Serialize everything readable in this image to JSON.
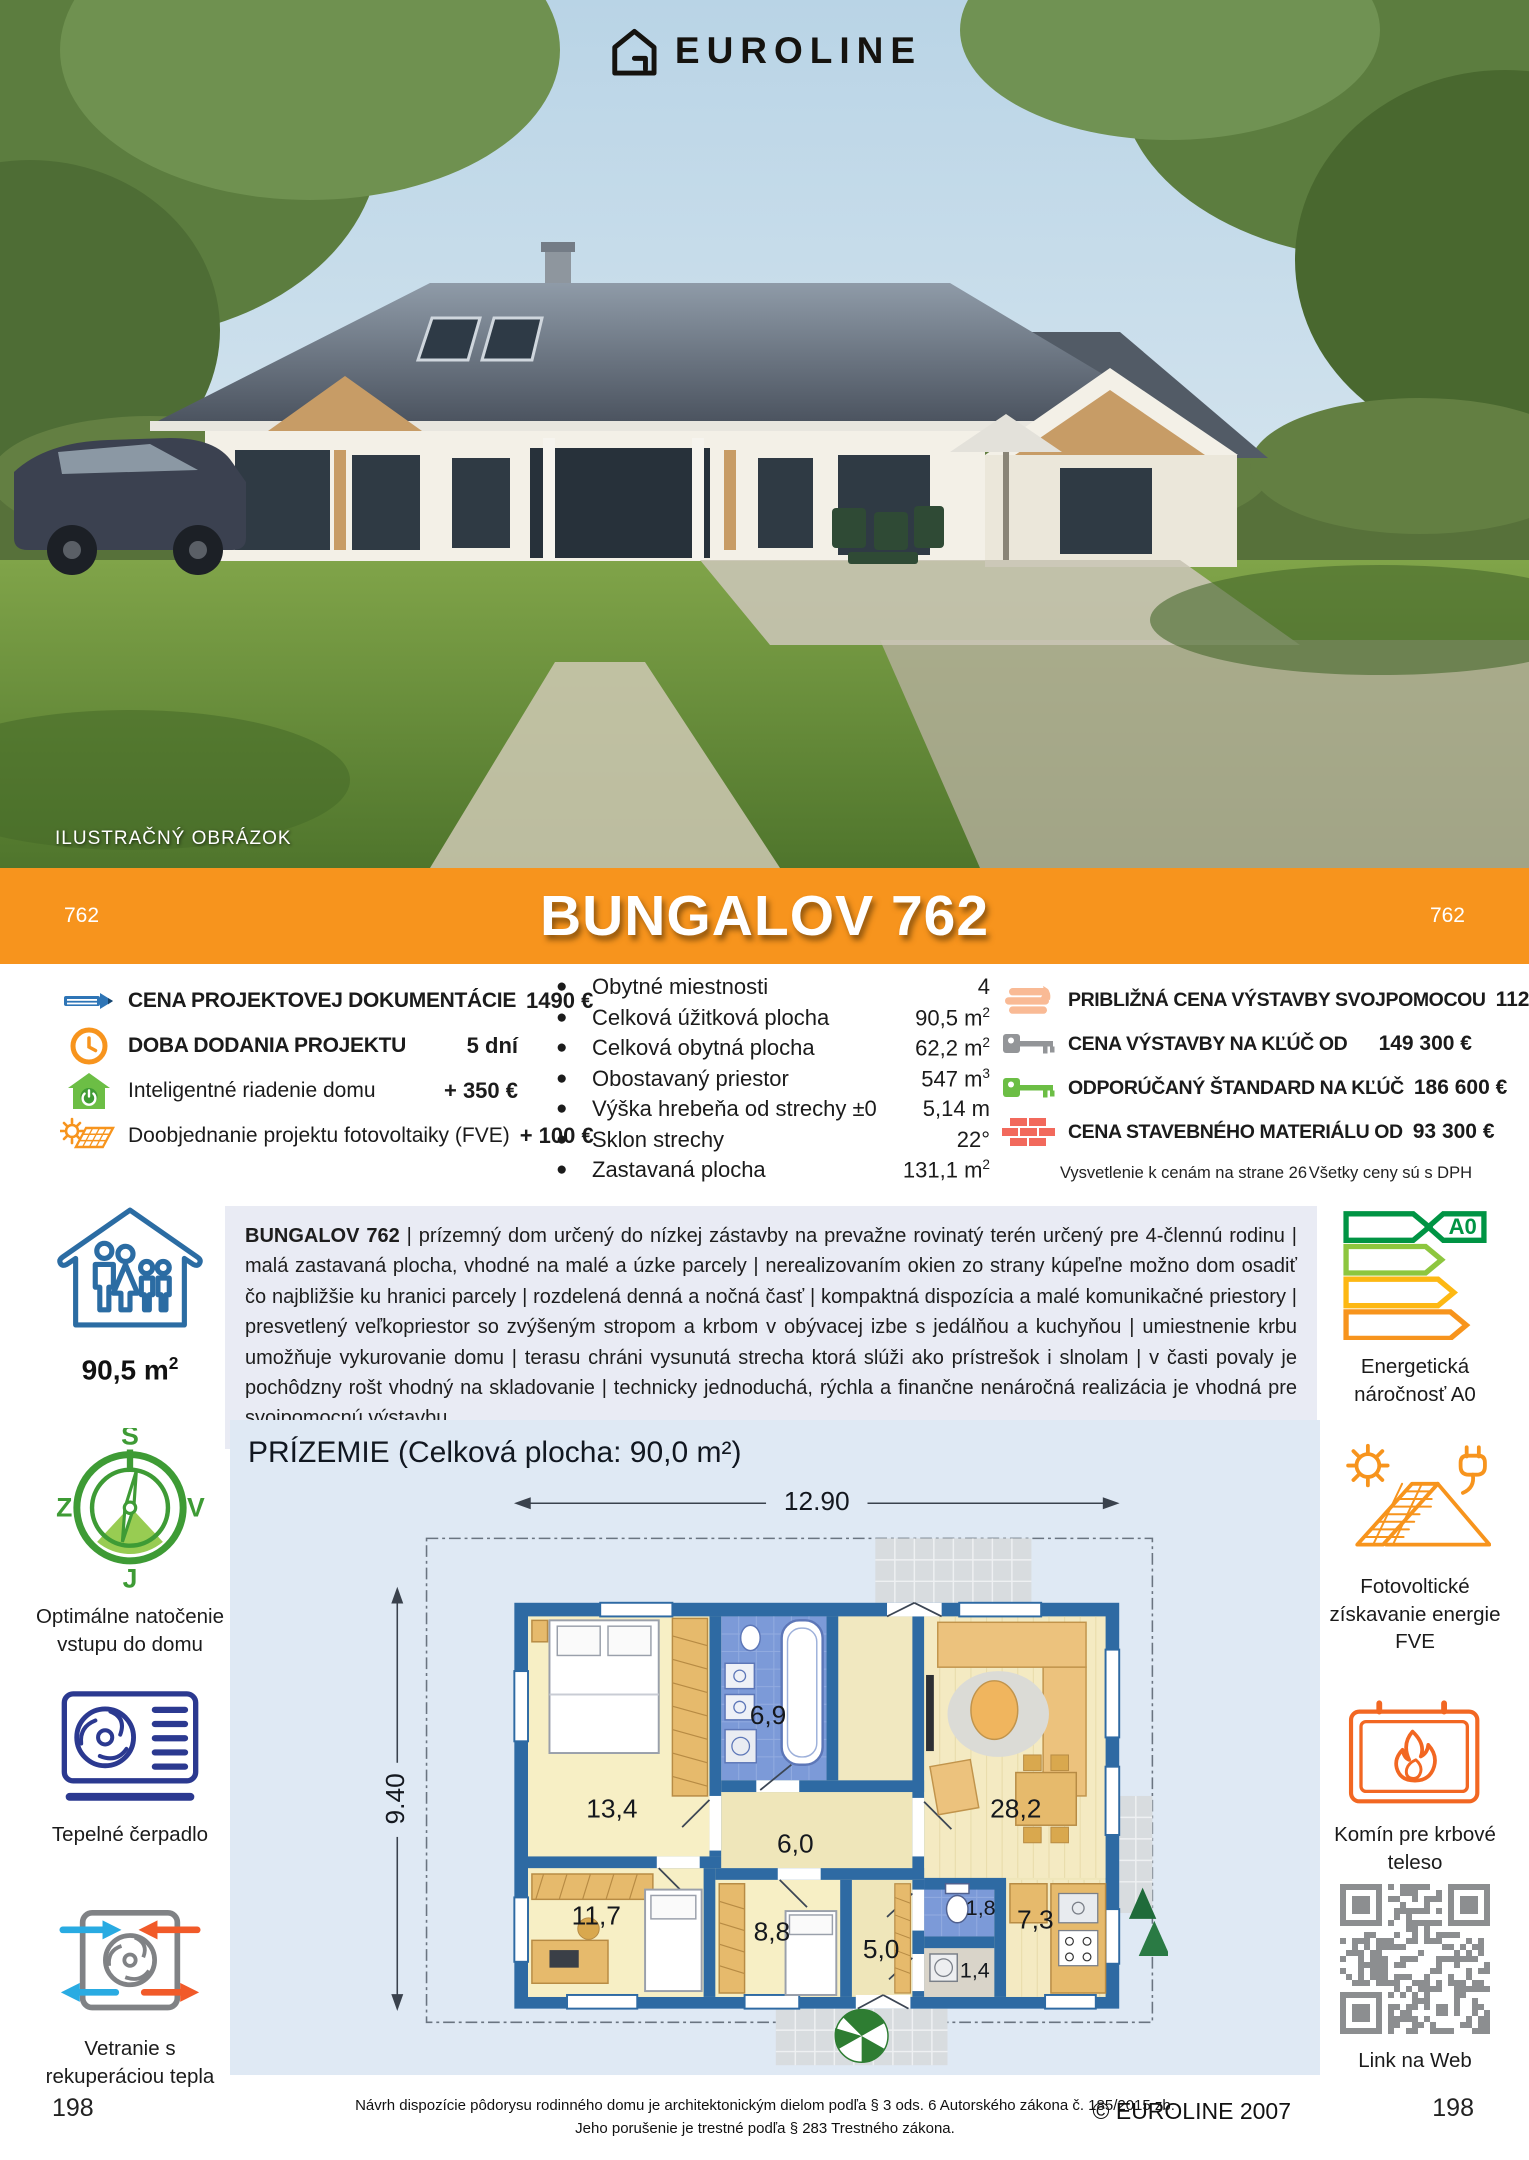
{
  "header": {
    "brand": "EUROLINE",
    "photo_caption": "ILUSTRAČNÝ OBRÁZOK",
    "title": "BUNGALOV 762",
    "model_left": "762",
    "model_right": "762"
  },
  "pricing_left": {
    "items": [
      {
        "icon": "pencil-icon",
        "label": "CENA PROJEKTOVEJ DOKUMENTÁCIE",
        "value": "1490 €"
      },
      {
        "icon": "clock-icon",
        "label": "DOBA DODANIA PROJEKTU",
        "value": "5 dní"
      },
      {
        "icon": "smart-home-icon",
        "label": "Inteligentné riadenie domu",
        "value": "+ 350 €"
      },
      {
        "icon": "solar-panel-icon",
        "label": "Doobjednanie projektu fotovoltaiky (FVE)",
        "value": "+ 100 €"
      }
    ]
  },
  "specs": {
    "items": [
      {
        "label": "Obytné miestnosti",
        "value": "4",
        "sup": ""
      },
      {
        "label": "Celková úžitková plocha",
        "value": "90,5 m",
        "sup": "2"
      },
      {
        "label": "Celková obytná plocha",
        "value": "62,2 m",
        "sup": "2"
      },
      {
        "label": "Obostavaný priestor",
        "value": "547 m",
        "sup": "3"
      },
      {
        "label": "Výška hrebeňa od strechy ±0",
        "value": "5,14 m",
        "sup": ""
      },
      {
        "label": "Sklon strechy",
        "value": "22°",
        "sup": ""
      },
      {
        "label": "Zastavaná plocha",
        "value": "131,1 m",
        "sup": "2"
      }
    ]
  },
  "pricing_right": {
    "items": [
      {
        "icon": "hand-icon",
        "label": "PRIBLIŽNÁ CENA VÝSTAVBY SVOJPOMOCOU",
        "value": "112 000 €"
      },
      {
        "icon": "key-gray-icon",
        "label": "CENA VÝSTAVBY NA KĽÚČ OD",
        "value": "149 300 €"
      },
      {
        "icon": "key-green-icon",
        "label": "ODPORÚČANÝ ŠTANDARD NA KĽÚČ",
        "value": "186 600 €"
      },
      {
        "icon": "bricks-icon",
        "label": "CENA STAVEBNÉHO MATERIÁLU OD",
        "value": "93 300 €"
      }
    ],
    "note_left": "Vysvetlenie k cenám na strane 26",
    "note_right": "Všetky ceny sú s DPH"
  },
  "description": {
    "lead": "BUNGALOV 762",
    "body": " | prízemný dom určený do nízkej zástavby na prevažne rovinatý terén určený pre 4-člennú rodinu | malá zastavaná plocha, vhodné na malé a úzke parcely | nerealizovaním okien zo strany kúpeľne možno dom osadiť čo najbližšie ku hranici parcely | rozdelená denná a nočná časť | kompaktná dispozícia a malé komunikačné priestory | presvetlený veľkopriestor so zvýšeným stropom a krbom v obývacej izbe s jedálňou a kuchyňou | umiestnenie krbu umožňuje vykurovanie domu | terasu chráni vysunutá strecha ktorá slúži ako prístrešok i slnolam | v časti povaly je pochôdzny rošt vhodný na skladovanie | technicky jednoduchá, rýchla a finančne nenáročná realizácia je vhodná pre svojpomocnú výstavbu"
  },
  "sidebar_left": {
    "area": {
      "value": "90,5 m",
      "sup": "2"
    },
    "compass": {
      "label": "Optimálne natočenie vstupu do domu",
      "n": "S",
      "s": "J",
      "w": "Z",
      "e": "V"
    },
    "heatpump": {
      "label": "Tepelné čerpadlo"
    },
    "ventilation": {
      "label": "Vetranie s rekuperáciou tepla"
    }
  },
  "sidebar_right": {
    "energy": {
      "label": "Energetická náročnosť A0",
      "badge": "A0"
    },
    "pv": {
      "label": "Fotovoltické získavanie energie FVE"
    },
    "fireplace": {
      "label": "Komín pre krbové teleso"
    },
    "qr": {
      "label": "Link na Web"
    }
  },
  "floorplan": {
    "title": "PRÍZEMIE (Celková plocha: 90,0 m²)",
    "dim_width": "12.90",
    "dim_height": "9.40",
    "rooms": [
      {
        "area": "13,4"
      },
      {
        "area": "6,9"
      },
      {
        "area": "28,2"
      },
      {
        "area": "6,0"
      },
      {
        "area": "11,7"
      },
      {
        "area": "8,8"
      },
      {
        "area": "5,0"
      },
      {
        "area": "1,8"
      },
      {
        "area": "1,4"
      },
      {
        "area": "7,3"
      }
    ]
  },
  "footer": {
    "page_left": "198",
    "page_right": "198",
    "copyright": "© EUROLINE 2007",
    "legal1": "Návrh dispozície pôdorysu rodinného domu je architektonickým dielom podľa § 3 ods. 6 Autorského zákona č. 185/2015 zb.",
    "legal2": "Jeho porušenie je trestné podľa § 283 Trestného zákona."
  },
  "colors": {
    "accent_orange": "#F7941D",
    "plan_wall_blue": "#2E6AA3",
    "panel_blue": "#dfe9f4",
    "desc_bg": "#e9ebf4"
  }
}
